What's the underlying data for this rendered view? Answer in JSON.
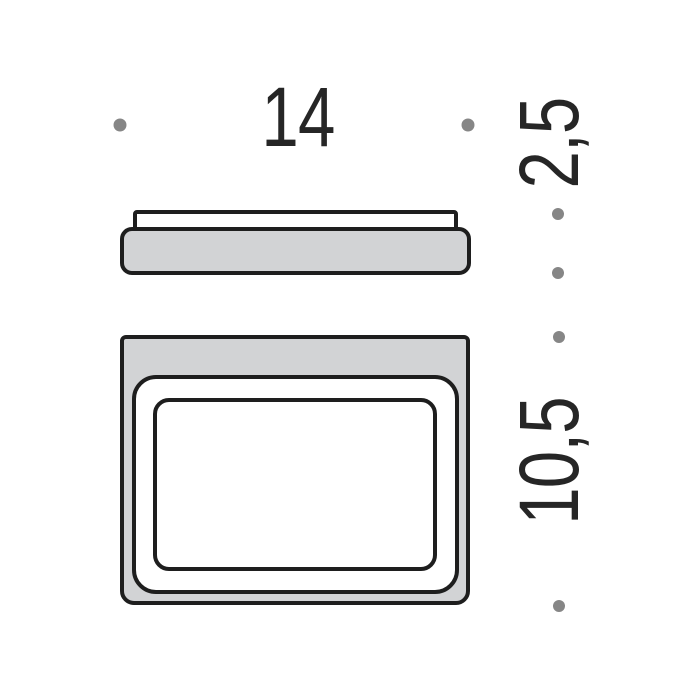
{
  "dimensions": {
    "width": {
      "label": "14"
    },
    "thickness": {
      "label": "2,5"
    },
    "depth": {
      "label": "10,5"
    }
  },
  "colors": {
    "outline": "#1e1e1e",
    "fill_gray": "#d2d3d5",
    "marker_dot": "#868686",
    "label_text": "#262626",
    "background": "#ffffff"
  }
}
